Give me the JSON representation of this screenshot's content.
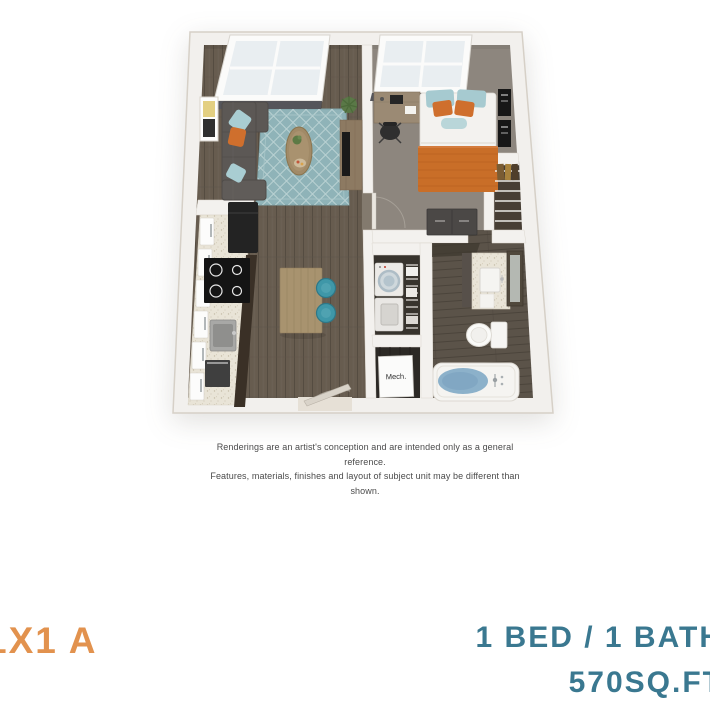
{
  "palette": {
    "plan_name_orange": "#E2924E",
    "spec_teal": "#3A7890",
    "disclaimer_gray": "#4B4B4B",
    "rug_teal": "#8FB3B8",
    "textile_orange": "#CF6F2D",
    "tub_water_blue": "#8CB1CA"
  },
  "floorplan": {
    "mech_label": "Mech."
  },
  "disclaimer": {
    "line1": "Renderings are an artist's conception and are intended only as a general reference.",
    "line2": "Features, materials, finishes and layout of subject unit may be different than shown."
  },
  "footer": {
    "plan_name": "1X1 A",
    "bed_bath": "1 BED / 1 BATH",
    "area": "570SQ.FT"
  }
}
